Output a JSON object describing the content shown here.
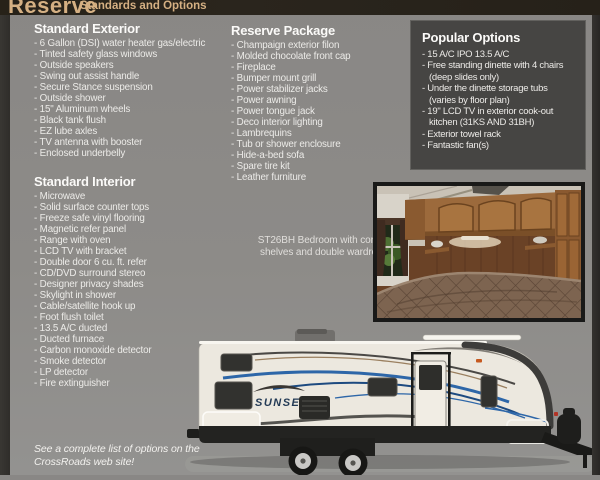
{
  "header": {
    "title": "Reserve",
    "subtitle": "Standards and Options"
  },
  "standard_exterior": {
    "heading": "Standard Exterior",
    "items": [
      "- 6 Gallon (DSI) water heater gas/electric",
      "- Tinted safety glass windows",
      "- Outside speakers",
      "- Swing out assist handle",
      "- Secure Stance suspension",
      "- Outside shower",
      "- 15\" Aluminum wheels",
      "- Black tank flush",
      "- EZ lube axles",
      "- TV antenna with booster",
      "- Enclosed underbelly"
    ]
  },
  "standard_interior": {
    "heading": "Standard Interior",
    "items": [
      "- Microwave",
      "- Solid surface counter tops",
      "- Freeze safe vinyl flooring",
      "- Magnetic refer panel",
      "- Range with oven",
      "- LCD TV with bracket",
      "- Double door 6 cu. ft. refer",
      "- CD/DVD surround stereo",
      "- Designer privacy shades",
      "- Skylight in shower",
      "- Cable/satellite hook up",
      "- Foot flush toilet",
      "- 13.5 A/C ducted",
      "- Ducted furnace",
      "- Carbon monoxide detector",
      "- Smoke detector",
      "- LP detector",
      "- Fire extinguisher"
    ]
  },
  "reserve_package": {
    "heading": "Reserve Package",
    "items": [
      "- Champaign exterior filon",
      "- Molded chocolate front cap",
      "- Fireplace",
      "- Bumper mount grill",
      "- Power stabilizer jacks",
      "- Power awning",
      "- Power tongue jack",
      "- Deco interior lighting",
      "- Lambrequins",
      "- Tub or shower enclosure",
      "- Hide-a-bed sofa",
      "- Spare tire kit",
      "- Leather furniture"
    ]
  },
  "popular_options": {
    "heading": "Popular Options",
    "items": [
      "- 15 A/C IPO 13.5 A/C",
      "- Free standing dinette with 4 chairs (deep slides only)",
      "- Under the dinette storage tubs (varies by floor plan)",
      "- 19\" LCD TV in exterior cook-out kitchen (31KS AND 31BH)",
      "- Exterior towel rack",
      "- Fantastic fan(s)"
    ]
  },
  "photo_caption": "ST26BH Bedroom with corner shelves and double wardrobe",
  "footnote": "See a complete list of options on the CrossRoads web site!",
  "trailer": {
    "brand": "SUNSET"
  },
  "colors": {
    "accent_tan": "#d5b083",
    "page_gray": "#8b8a87",
    "bar_dark": "#272219",
    "box_dark": "#464543",
    "swoosh_blue": "#2d66a8"
  }
}
